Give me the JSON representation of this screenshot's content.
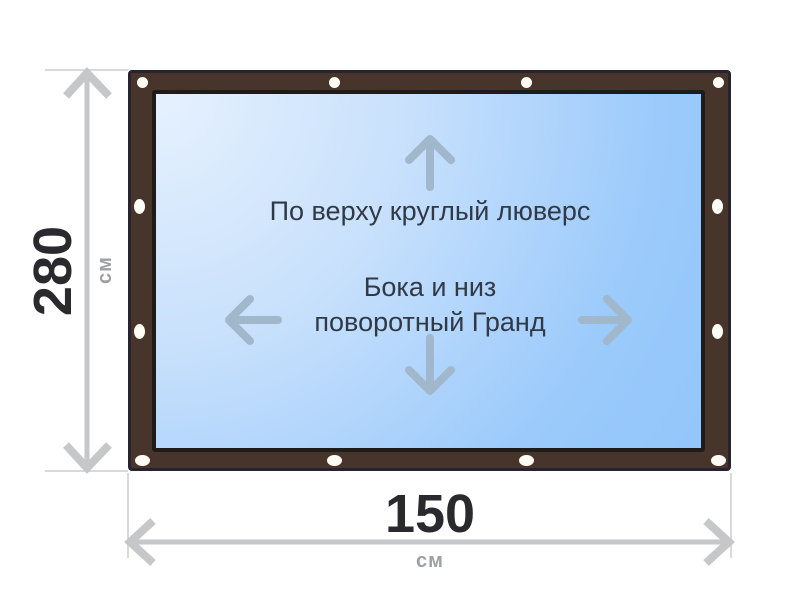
{
  "page": {
    "type": "product-size-diagram",
    "background_color": "#ffffff"
  },
  "banner": {
    "frame_color": "#47342a",
    "frame_border_color": "#272430",
    "panel_border_color": "#1f1b18",
    "panel_gradient_start": "#e6f1fe",
    "panel_gradient_end": "#93c6fb",
    "grommet_color": "#fffdf6",
    "grommet_count": 12,
    "annotations": {
      "text_color": "#313945",
      "arrow_color": "#a1b7cb",
      "top_label": "По верху круглый люверс",
      "center_label_line1": "Бока и низ",
      "center_label_line2": "поворотный Гранд",
      "icons": {
        "up": "up-arrow-icon",
        "left": "left-arrow-icon",
        "right": "right-arrow-icon",
        "down": "down-arrow-icon"
      }
    }
  },
  "dimensions": {
    "line_color": "#c6c7c9",
    "extension_line_color": "#d9d9d9",
    "value_color": "#29292e",
    "unit_color": "#9fa0a2",
    "height": {
      "value": "280",
      "unit": "см"
    },
    "width": {
      "value": "150",
      "unit": "см"
    }
  }
}
